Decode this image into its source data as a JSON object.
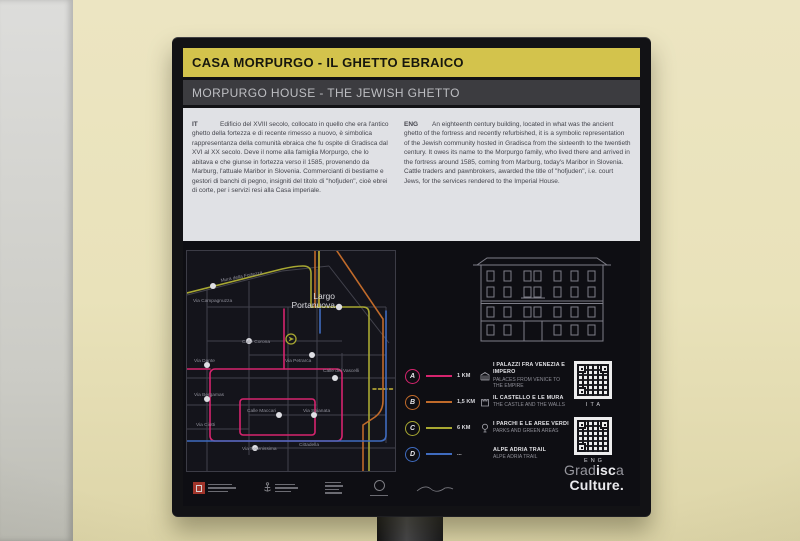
{
  "sign": {
    "title_it": "CASA MORPURGO - IL GHETTO EBRAICO",
    "title_en": "MORPURGO HOUSE - THE JEWISH GHETTO",
    "intro": {
      "it_label": "IT",
      "it_text": "Edificio del XVIII secolo, collocato in quello che era l'antico ghetto della fortezza e di recente rimesso a nuovo, è simbolica rappresentanza della comunità ebraica che fu ospite di Gradisca dal XVI al XX secolo. Deve il nome alla famiglia Morpurgo, che lo abitava e che giunse in fortezza verso il 1585, provenendo da Marburg, l'attuale Maribor in Slovenia. Commercianti di bestiame e gestori di banchi di pegno, insigniti del titolo di \"hofjuden\", cioè ebrei di corte, per i servizi resi alla Casa imperiale.",
      "eng_label": "ENG",
      "eng_text": "An eighteenth century building, located in what was the ancient ghetto of the fortress and recently refurbished, it is a symbolic representation of the Jewish community hosted in Gradisca from the sixteenth to the twentieth century. It owes its name to the Morpurgo family, who lived there and arrived in the fortress around 1585, coming from Marburg, today's Maribor in Slovenia. Cattle traders and pawnbrokers, awarded the title of \"hofjuden\", i.e. court Jews, for the services rendered to the Imperial House."
    }
  },
  "map": {
    "place_line1": "Largo",
    "place_line2": "Portanuova",
    "street_labels": [
      "Mura della Fortezza",
      "Via Campagnuzza",
      "Calle Corona",
      "Via Dante",
      "Via Petrarca",
      "Calle dei Vascelli",
      "Via Bergamas",
      "Calle Maccari",
      "Via Spianata",
      "Via Ciotti",
      "Via Serenissima",
      "Cittadella"
    ]
  },
  "legend": {
    "items": [
      {
        "letter": "A",
        "color": "#d6246e",
        "distance": "1 KM",
        "icon": "palace-icon",
        "title_it": "I PALAZZI FRA VENEZIA E IMPERO",
        "title_en": "PALACES FROM VENICE TO THE EMPIRE"
      },
      {
        "letter": "B",
        "color": "#c06a2a",
        "distance": "1,5 KM",
        "icon": "castle-icon",
        "title_it": "IL CASTELLO E LE MURA",
        "title_en": "THE CASTLE AND THE WALLS"
      },
      {
        "letter": "C",
        "color": "#a8a832",
        "distance": "6 KM",
        "icon": "tree-icon",
        "title_it": "I PARCHI E LE AREE VERDI",
        "title_en": "PARKS AND GREEN AREAS"
      },
      {
        "letter": "D",
        "color": "#3f6bbf",
        "distance": "...",
        "icon": "trail-icon",
        "title_it": "ALPE ADRIA TRAIL",
        "title_en": "ALPE ADRIA TRAIL"
      }
    ]
  },
  "qr": {
    "ita_label": "ITA",
    "eng_label": "ENG"
  },
  "brand": {
    "pre": "Grad",
    "mid": "isc",
    "post": "a",
    "line2": "Culture."
  },
  "colors": {
    "accent_yellow": "#d3c34c",
    "route_pink": "#d6246e",
    "route_orange": "#c06a2a",
    "route_green": "#a8a832",
    "route_blue": "#3f6bbf"
  }
}
